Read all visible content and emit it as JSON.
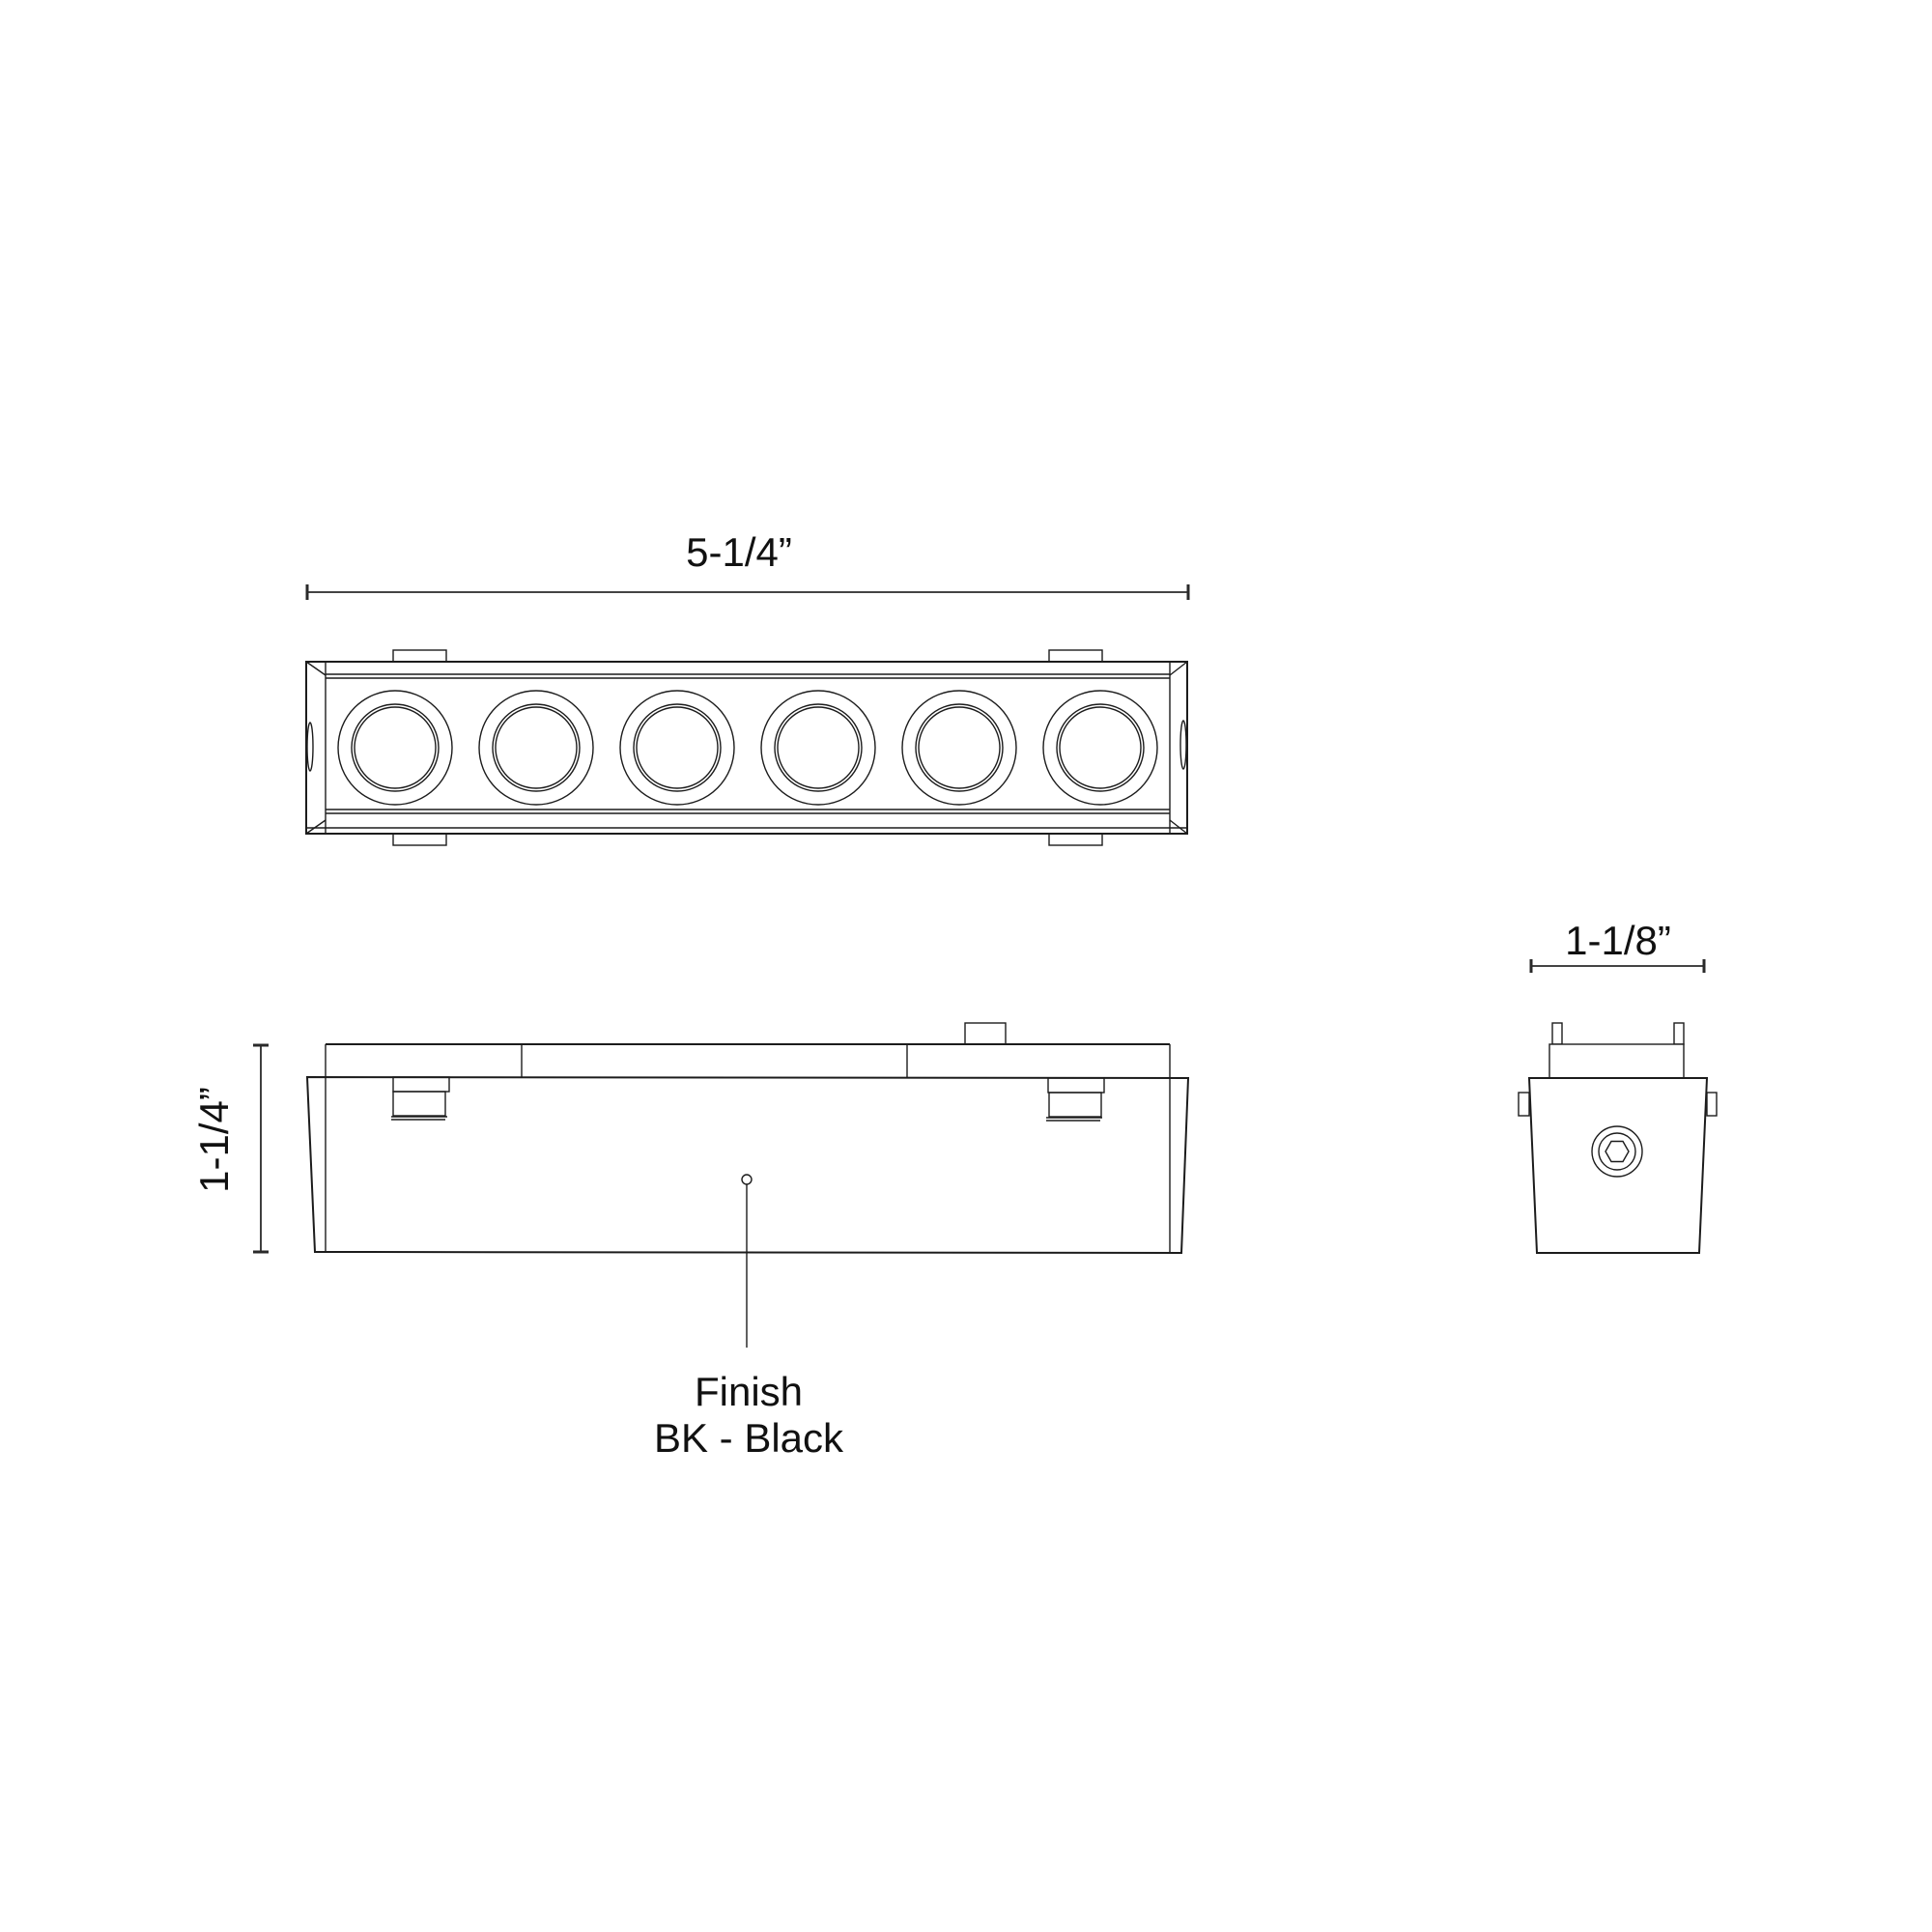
{
  "drawing": {
    "background_color": "#ffffff",
    "line_color": "#1c1c1c",
    "views": {
      "top_view": {
        "name": "fixture top view",
        "dimension_label": "5-1/4”",
        "lamp_count": 6
      },
      "front_view": {
        "name": "fixture front view",
        "dimension_label": "1-1/4”",
        "finish_note": {
          "title": "Finish",
          "value": "BK - Black"
        }
      },
      "end_view": {
        "name": "fixture end view",
        "dimension_label": "1-1/8”"
      }
    }
  }
}
